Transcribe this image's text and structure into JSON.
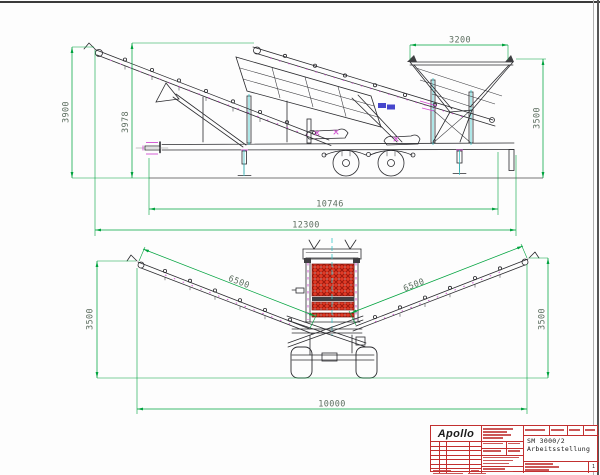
{
  "drawing": {
    "side_view": {
      "dim_hopper_width": "3200",
      "dim_height_discharge": "3900",
      "dim_height_feed": "3978",
      "dim_height_right": "3500",
      "dim_length_chassis": "10746",
      "dim_length_overall": "12300"
    },
    "rear_view": {
      "dim_conveyor_left": "6500",
      "dim_conveyor_right": "6500",
      "dim_height_left": "3500",
      "dim_height_right": "3500",
      "dim_width_overall": "10000"
    },
    "title_block": {
      "company": "Apollo",
      "model": "SM 3000/2",
      "subtitle": "Arbeitsstellung",
      "sheet_number": "1"
    },
    "colors": {
      "dimension_line": "#00a33e",
      "dimension_text": "#5d6e60",
      "titleblock_red": "#c23030",
      "mesh_red": "#e13a26",
      "accent_magenta": "#d14fd1",
      "accent_cyan": "#38c6ca"
    }
  }
}
